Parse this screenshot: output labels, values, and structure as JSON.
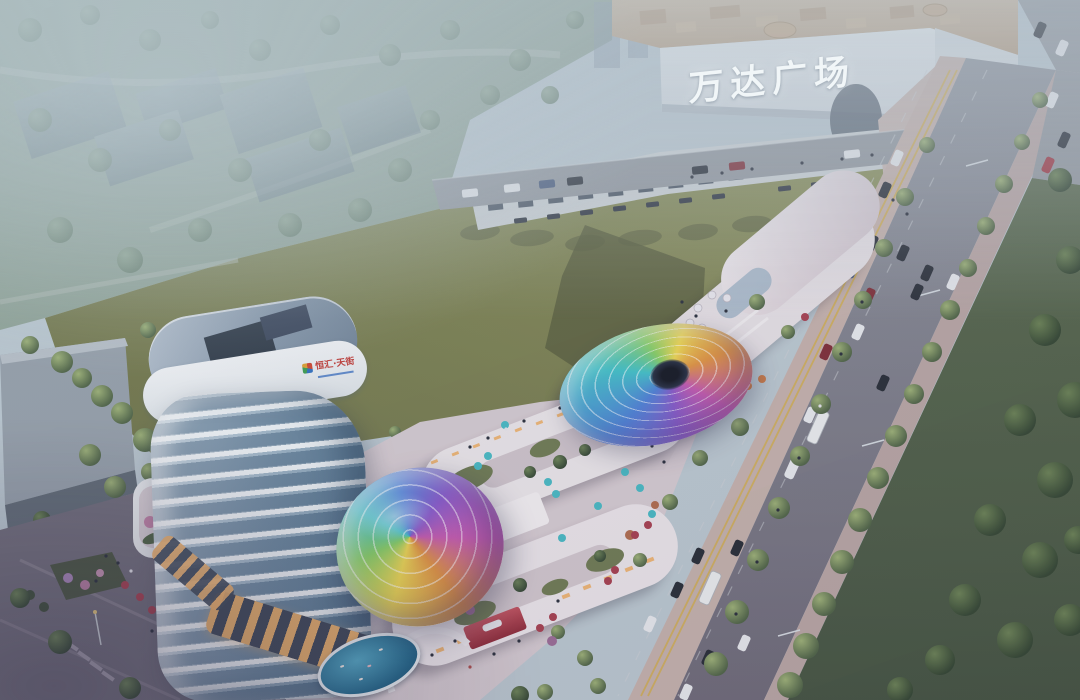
{
  "scene": {
    "description": "Aerial dusk rendering of a mixed-use retail street with iridescent glass canopies, a curved white tower, a large lawn and the Wanda Plaza mall",
    "mall_sign": "万达广场",
    "tower_logo": "恒汇·天街"
  },
  "colors": {
    "haze": "#bcc9d1",
    "parkgreen": "#8fa396",
    "lawn": "#7c814f",
    "lawnshadow": "#575c3b",
    "road": "#93989f",
    "roaddark": "#6f6b79",
    "sidewalk": "#c6b2ac",
    "sidewalk2": "#b9a6a4",
    "parkstrip": "#4f5f47",
    "mallface": "#e3e8ec",
    "mallroof": "#c6ae94",
    "white": "#efebee",
    "plaza": "#d6cbd1",
    "glass": "#9db3c6",
    "ledred": "#a3313f",
    "teal": "#45b9c3",
    "red": "#a63c4c",
    "orange": "#cc7a45",
    "yellow": "#d2ae4e"
  }
}
